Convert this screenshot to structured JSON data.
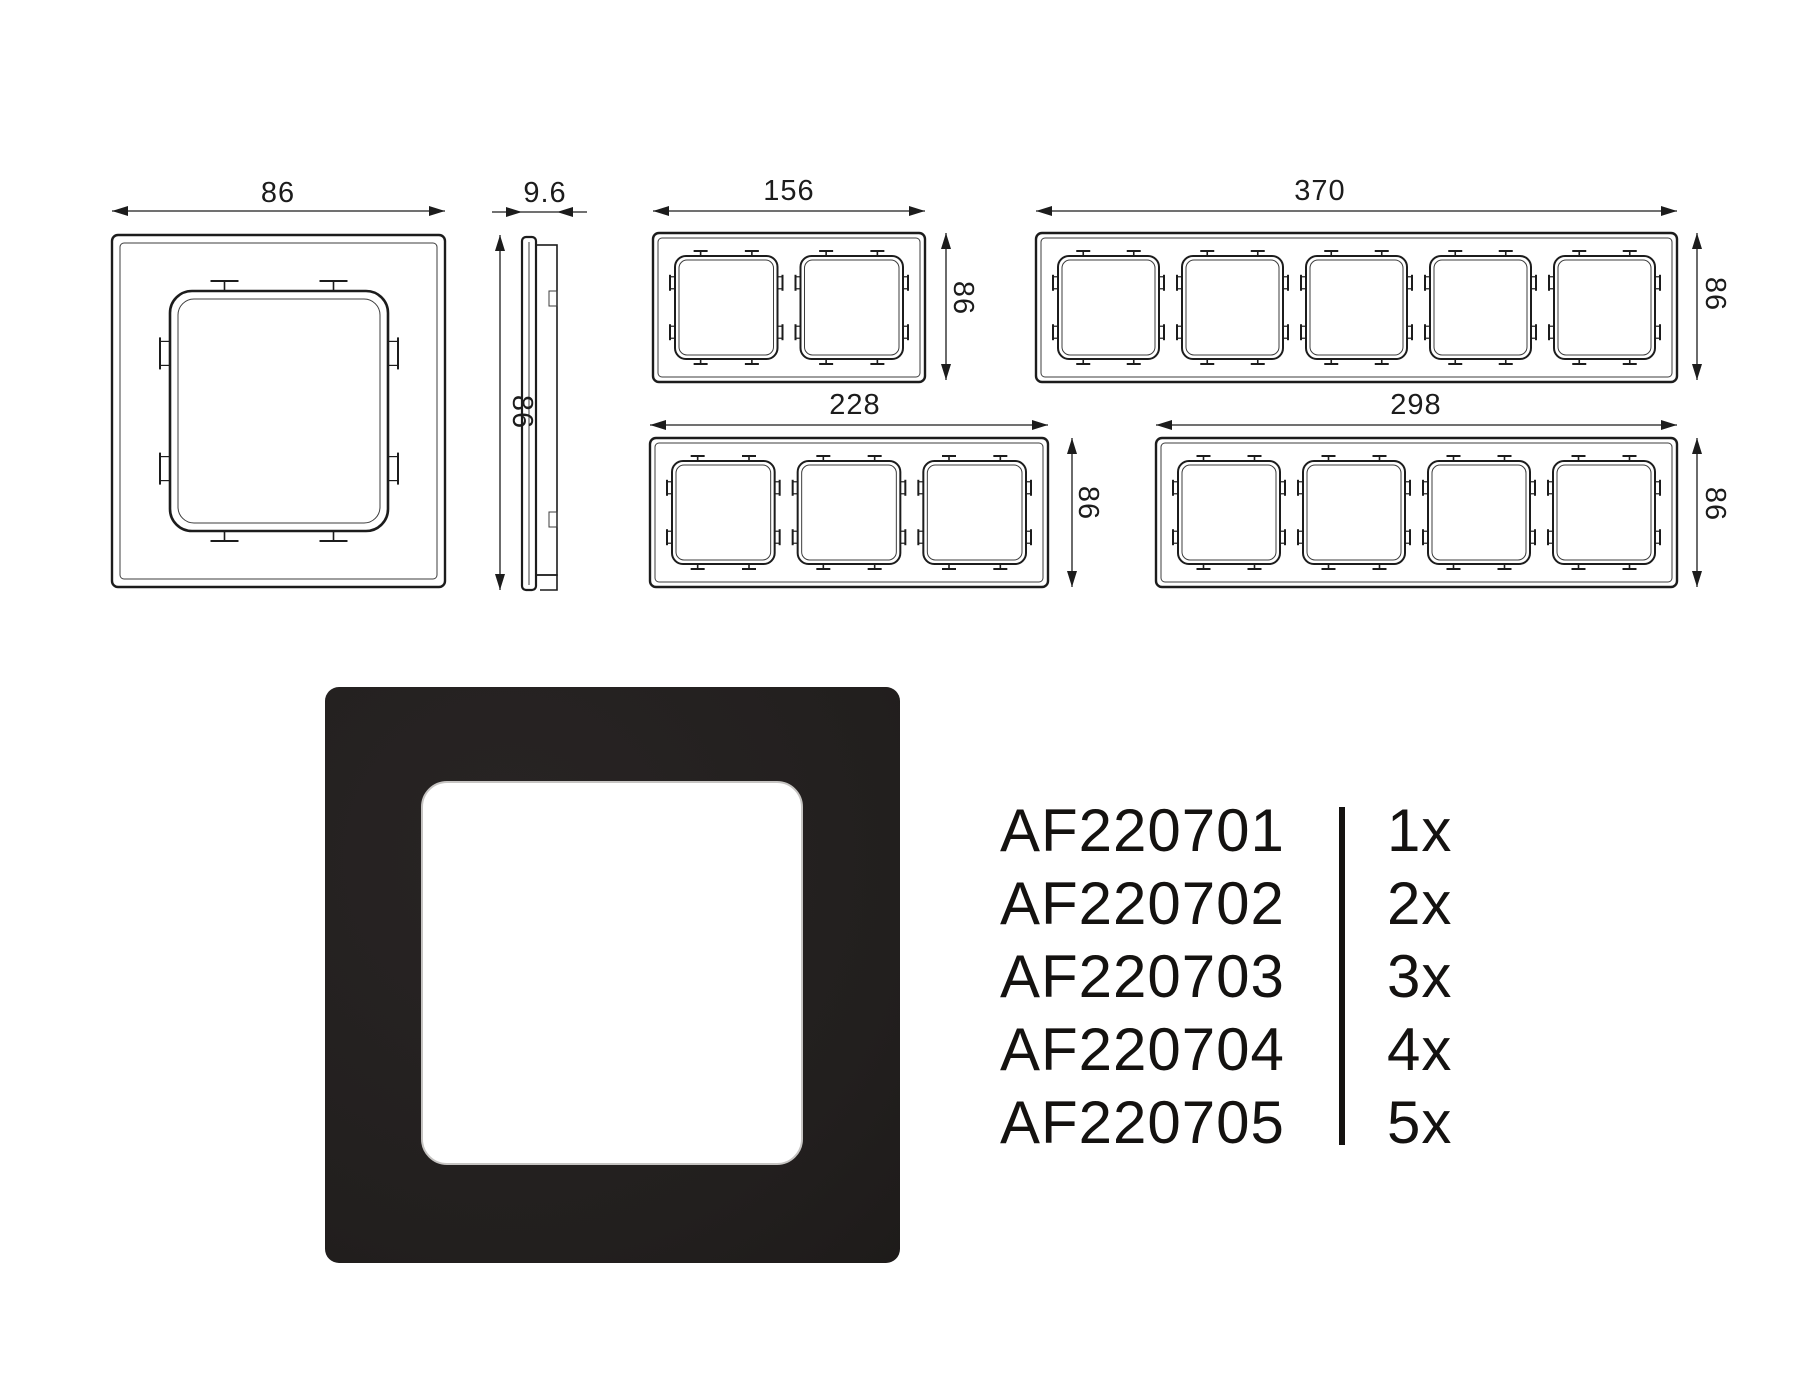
{
  "dimensions": {
    "single_width": "86",
    "single_height": "86",
    "side_depth": "9.6",
    "two_gang_width": "156",
    "two_gang_height": "86",
    "three_gang_width": "228",
    "three_gang_height": "86",
    "four_gang_width": "298",
    "four_gang_height": "86",
    "five_gang_width": "370",
    "five_gang_height": "86"
  },
  "product_table": {
    "rows": [
      {
        "code": "AF220701",
        "qty": "1x"
      },
      {
        "code": "AF220702",
        "qty": "2x"
      },
      {
        "code": "AF220703",
        "qty": "3x"
      },
      {
        "code": "AF220704",
        "qty": "4x"
      },
      {
        "code": "AF220705",
        "qty": "5x"
      }
    ]
  },
  "colors": {
    "line": "#1c1c1c",
    "line_soft": "#3c3c3c",
    "frame_black": "#232020",
    "bevel": "#c6c4c2",
    "text": "#141210"
  }
}
